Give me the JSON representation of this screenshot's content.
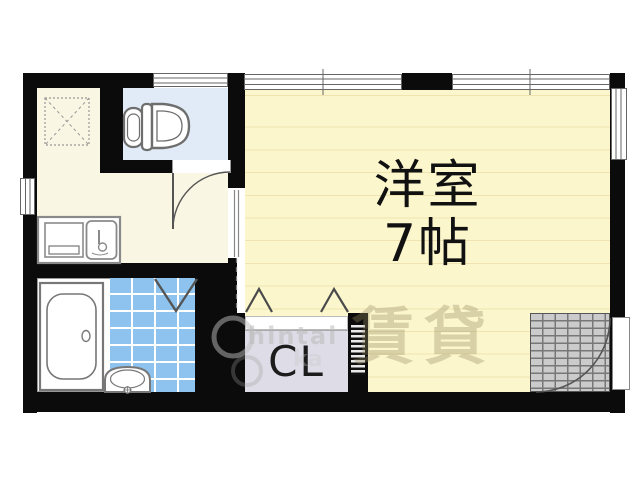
{
  "plan": {
    "main_room_name": "洋室",
    "main_room_size": "7帖",
    "closet_label": "CL"
  },
  "watermark": {
    "text_1": "hintai",
    "text_2": "ka",
    "cjk": "賃貸"
  },
  "colors": {
    "wall": "#0b0b0b",
    "main_room_floor": "#fcf6cd",
    "floor_stripe": "#efe4b1",
    "hallway_floor": "#f9f6e3",
    "toilet_floor": "#e1ebf7",
    "bath_tile": "#8dc3ee",
    "closet_fill": "#dedce6",
    "entrance_tile": "#cbcbcb",
    "fixture_outline": "#777777",
    "label_color": "#111111"
  },
  "icons": {
    "toilet": "toilet-icon",
    "bathtub": "bathtub-icon",
    "washbasin": "washbasin-icon",
    "kitchen_sink": "kitchen-sink-icon",
    "stove": "stove-icon",
    "washing_machine_area": "washing-machine-area-icon",
    "toilet_door": "toilet-door-arc-icon",
    "entrance_door": "entrance-door-arc-icon",
    "bath_folding_door": "bath-folding-door-icon",
    "closet_doors": "closet-folding-door-icon",
    "window": "window-icon"
  }
}
